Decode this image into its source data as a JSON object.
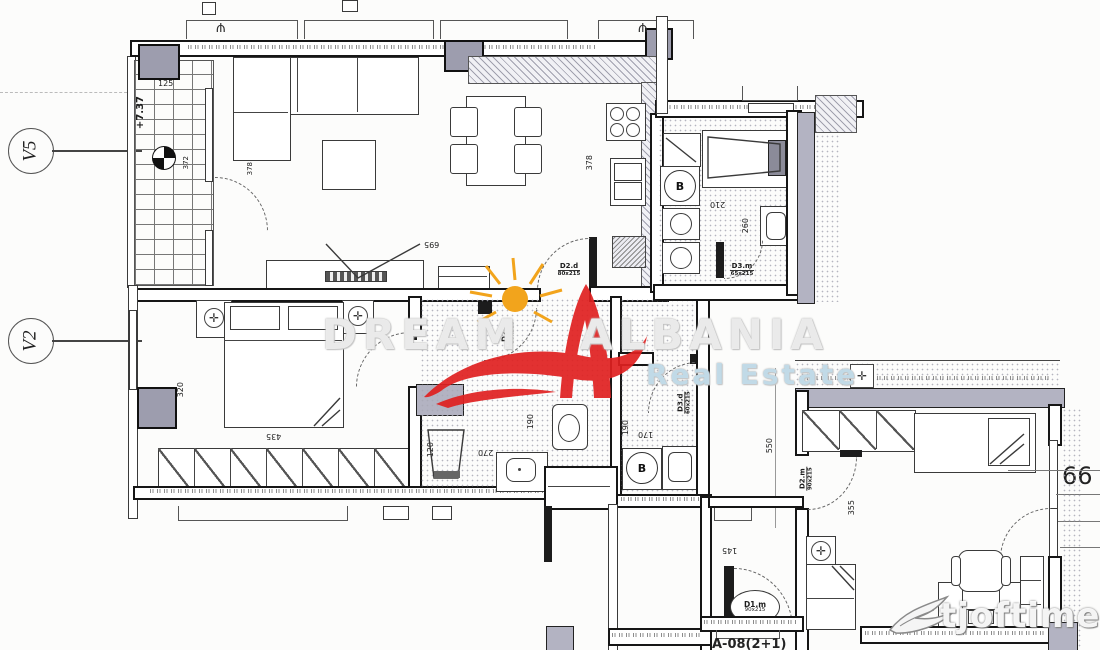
{
  "labels": {
    "v5": "V5",
    "v2": "V2",
    "elevation": "+7.37",
    "boiler": "B",
    "room_number": "66",
    "unit_code": "A-08(2+1)"
  },
  "dims": {
    "balcony_w": "125",
    "balcony_l": "372",
    "balcony_door": "378",
    "kitchen": "378",
    "living": "695",
    "bedroom_window": "320",
    "wardrobe": "435",
    "shower": "120",
    "bath2_w": "270",
    "bath2_d": "190",
    "bath1_w": "210",
    "bath1_d": "260",
    "hall_w": "190",
    "hall_d": "170",
    "corridor": "550",
    "entry": "145",
    "bedroom2": "355"
  },
  "doors": {
    "living_hall": {
      "name": "D2.d",
      "size": "80x215"
    },
    "bath2": {
      "name": "D2.d",
      "size": "80x215"
    },
    "bath1": {
      "name": "D3.m",
      "size": "65x215"
    },
    "hall": {
      "name": "D3.d",
      "size": "60x215"
    },
    "bedroom2": {
      "name": "D2.m",
      "size": "90x215"
    },
    "entrance": {
      "name": "D1.m",
      "size": "90x215"
    }
  },
  "watermark": {
    "brand_left": "DREAM",
    "brand_right": "ALBANIA",
    "subtitle": "Real Estate",
    "site": "tjoftime.al"
  },
  "colors": {
    "wall": "#1a1a1a",
    "column": "#9d9dae",
    "logo_red": "#e02020",
    "sun_yellow": "#f2a41c",
    "watermark_blue": "#cfe3f0"
  }
}
